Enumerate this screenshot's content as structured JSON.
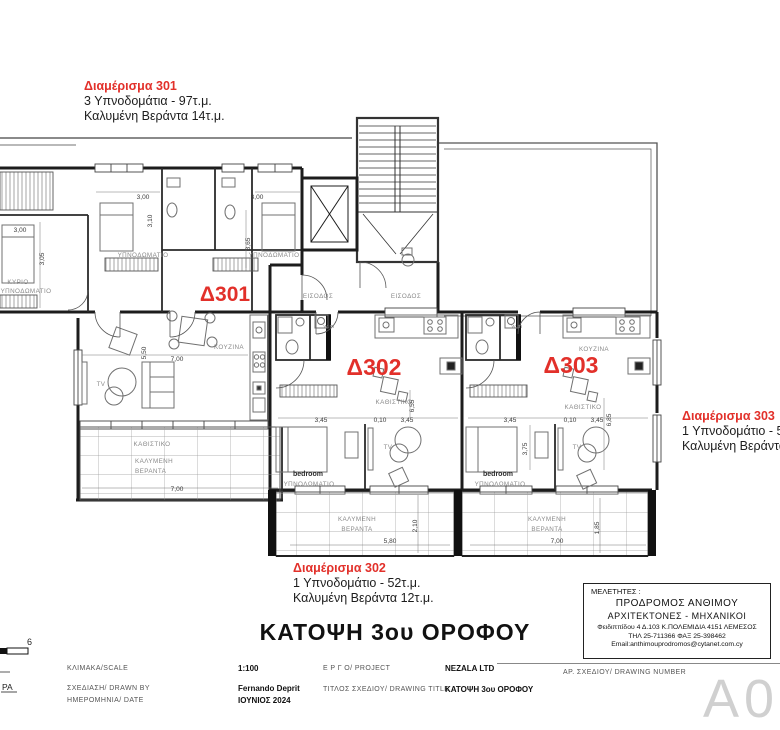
{
  "colors": {
    "accent_red": "#e2302a",
    "wall": "#1c1c1c",
    "furniture": "#707070"
  },
  "annotations": {
    "apt301": {
      "title": "Διαμέρισμα 301",
      "line1": "3 Υπνοδομάτια - 97τ.μ.",
      "line2": "Καλυμένη Βεράντα 14τ.μ."
    },
    "apt302": {
      "title": "Διαμέρισμα 302",
      "line1": "1 Υπνοδομάτιο - 52τ.μ.",
      "line2": "Καλυμένη Βεράντα 12τ.μ."
    },
    "apt303": {
      "title": "Διαμέρισμα 303",
      "line1": "1 Υπνοδομάτιο - 54τ.μ.",
      "line2": "Καλυμένη Βεράντα 14τ.μ."
    },
    "unit_labels": {
      "d301": "Δ301",
      "d302": "Δ302",
      "d303": "Δ303"
    }
  },
  "plan": {
    "label_bedroom": "ΥΠΝΟΔΩΜΑΤΙΟ",
    "label_main1": "ΚΥΡΙΟ",
    "label_bedroom_en": "bedroom",
    "label_entrance": "ΕΙΣΟΔΟΣ",
    "label_kitchen": "ΚΟΥΖΙΝΑ",
    "label_living": "ΚΑΘΙΣΤΙΚΟ",
    "label_veranda1": "ΚΑΛΥΜΕΝΗ",
    "label_veranda2": "ΒΕΡΑΝΤΑ",
    "label_tv": "TV",
    "label_wm": "w.m"
  },
  "dims": {
    "d300": "3,00",
    "d305": "3,05",
    "d310": "3,10",
    "d365": "3,65",
    "d550": "5,50",
    "d700": "7,00",
    "d345": "3,45",
    "d010": "0,10",
    "d655": "6,55",
    "d580": "5,80",
    "d210": "2,10",
    "d375": "3,75",
    "d685": "6,85",
    "d185": "1,85"
  },
  "title": "ΚΑΤΟΨΗ 3ου ΟΡΟΦΟΥ",
  "title_block": {
    "heading": "ΜΕΛΕΤΗΤΕΣ :",
    "name": "ΠΡΟΔΡΟΜΟΣ ΑΝΘΙΜΟΥ",
    "profession": "ΑΡΧΙΤΕΚΤΟΝΕΣ - ΜΗΧΑΝΙΚΟΙ",
    "address": "Φειδιππίδου 4 Δ.103 Κ.ΠΟΛΕΜΙΔΙΑ 4151 ΛΕΜΕΣΟΣ",
    "phone": "ΤΗΛ 25-711366   ΦΑΞ 25-398462",
    "email": "Email:anthimouprodromos@cytanet.com.cy"
  },
  "info_table": {
    "scale_label": "ΚΛΙΜΑΚΑ/SCALE",
    "scale_value": "1:100",
    "drawn_label": "ΣΧΕΔΙΑΣΗ/ DRAWN BY",
    "drawn_value": "Fernando Deprit",
    "date_label": "ΗΜΕΡΟΜΗΝΙΑ/ DATE",
    "date_value": "ΙΟΥΝΙΟΣ 2024",
    "project_label": "Ε Ρ Γ Ο/ PROJECT",
    "project_value": "NEZALA LTD",
    "drawing_title_label": "ΤΙΤΛΟΣ ΣΧΕΔΙΟΥ/ DRAWING TITLE",
    "drawing_title_value": "ΚΑΤΟΨΗ 3ου ΟΡΟΦΟΥ",
    "number_label": "ΑΡ. ΣΧΕΔΙΟΥ/ DRAWING NUMBER",
    "number_value": "A02"
  },
  "scale_bar": {
    "number": "6",
    "partial_label": "ΡΑ"
  }
}
